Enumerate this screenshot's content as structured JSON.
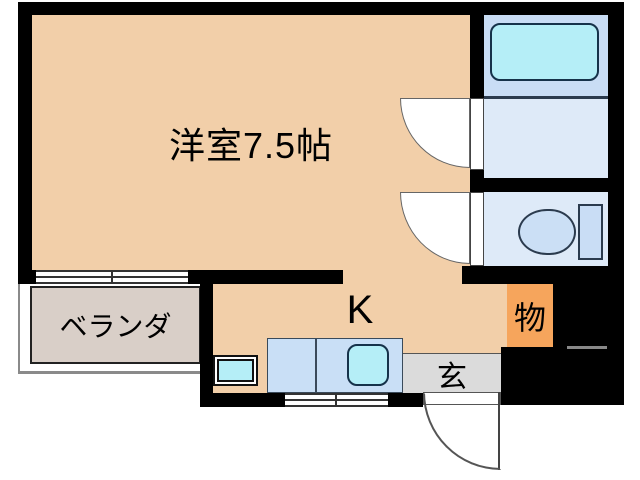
{
  "floorplan": {
    "main_room_label": "洋室7.5帖",
    "kitchen_label": "K",
    "veranda_label": "ベランダ",
    "storage_label": "物",
    "entrance_label": "玄",
    "fixtures": [
      "bathtub",
      "toilet",
      "kitchen-sink",
      "washing-machine-pan",
      "sliding-window",
      "door-swing-arc"
    ]
  },
  "colors": {
    "wall": "#000000",
    "main_room": "#F2CFA9",
    "veranda": "#D9CFC8",
    "storage": "#F6A55C",
    "entrance": "#DBDBDB",
    "bath": "#C9DDF5",
    "washroom": "#DEEAF8",
    "fixture": "#B5EEF7",
    "counter": "#C9DFF6",
    "bowl": "#CBDFF5"
  }
}
